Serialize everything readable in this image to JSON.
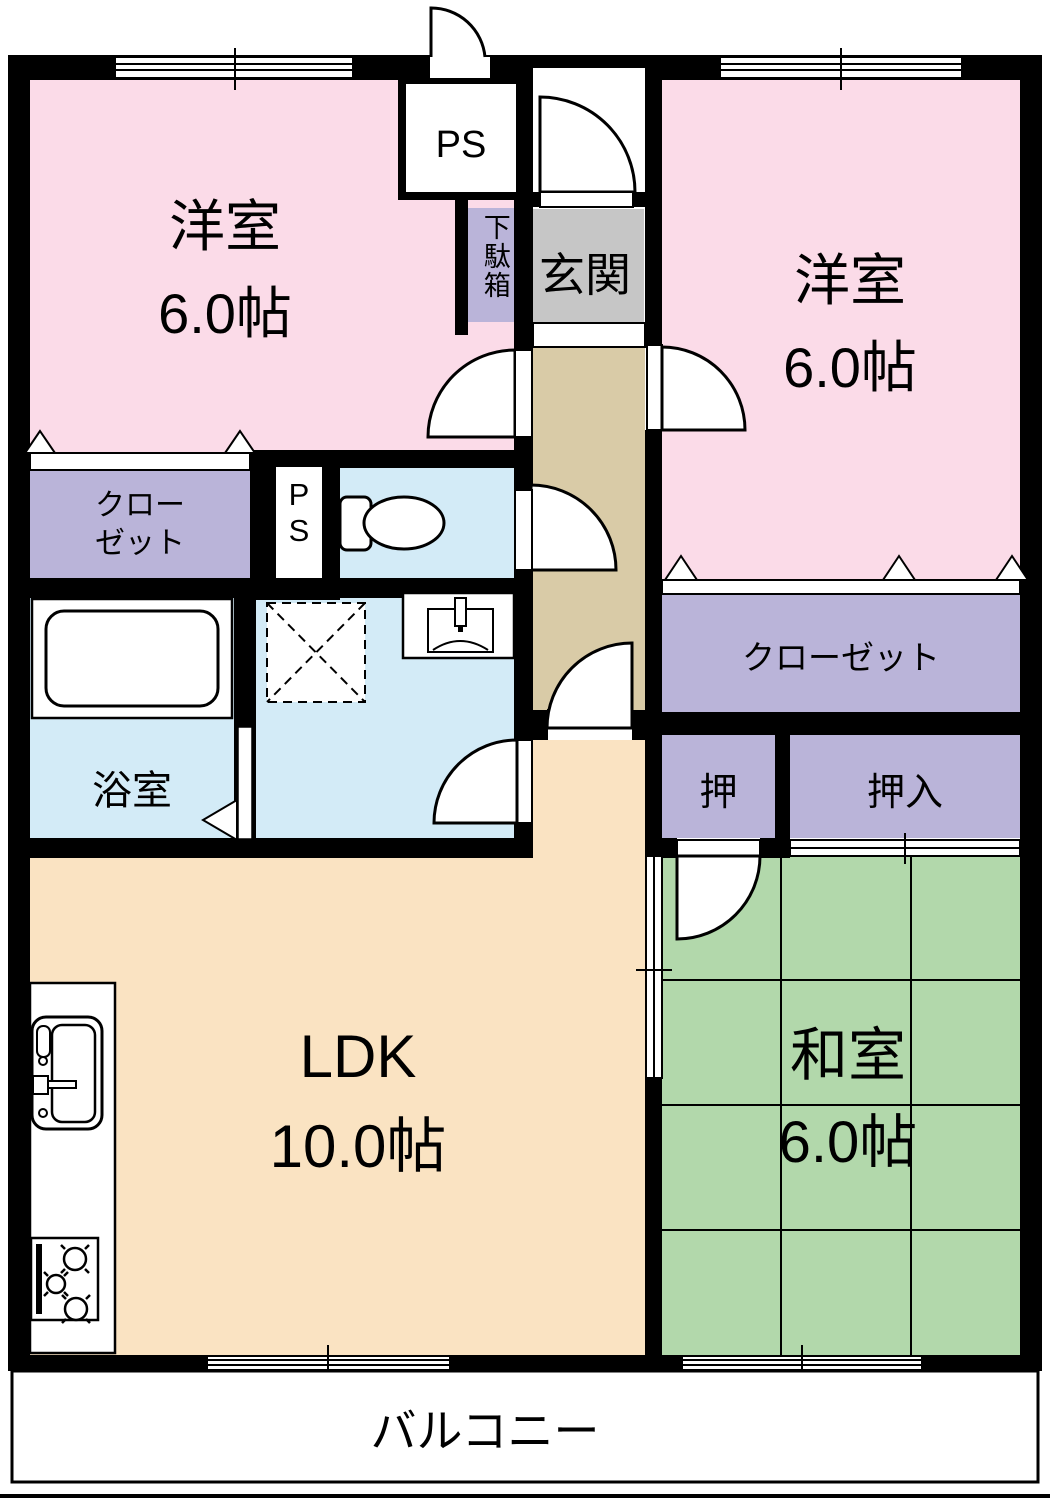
{
  "plan_type": "apartment-floorplan",
  "rooms": {
    "western_left": {
      "name": "洋室",
      "size": "6.0帖"
    },
    "western_right": {
      "name": "洋室",
      "size": "6.0帖"
    },
    "japanese": {
      "name": "和室",
      "size": "6.0帖"
    },
    "ldk": {
      "name": "LDK",
      "size": "10.0帖"
    },
    "bathroom": {
      "name": "浴室"
    },
    "entrance": {
      "name": "玄関"
    },
    "balcony": {
      "name": "バルコニー"
    },
    "closet_left": {
      "line1": "クロー",
      "line2": "ゼット"
    },
    "closet_right": {
      "name": "クローゼット"
    },
    "oshi": {
      "name": "押"
    },
    "oshiire": {
      "name": "押入"
    },
    "shoe_cabinet": {
      "name": "下駄箱"
    },
    "pipe_space_top": {
      "name": "PS"
    },
    "pipe_space_mid": {
      "line1": "P",
      "line2": "S"
    }
  },
  "colors": {
    "western_room": "#fbdbe8",
    "japanese_room": "#b2d8ab",
    "ldk": "#fae3c2",
    "hallway": "#d9cba7",
    "wet_area": "#d3ebf7",
    "closet": "#bab4d9",
    "entrance_floor": "#c6c6c6",
    "wall": "#000000",
    "floor_bg": "#ffffff"
  }
}
